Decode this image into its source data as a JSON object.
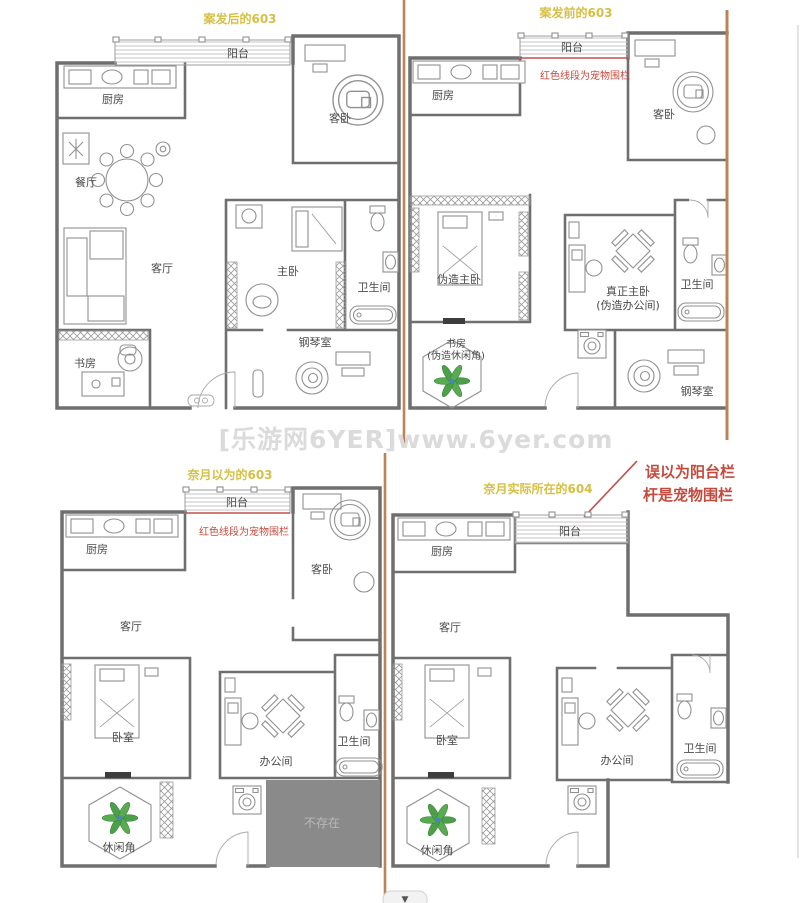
{
  "watermark": {
    "text": "[乐游网6YER]www.6yer.com"
  },
  "page": {
    "scroll_indicator": "▼"
  },
  "colors": {
    "title_yellow": "#d6bf45",
    "annotation_red": "#c44a3d",
    "pet_fence_red": "#c0504d",
    "wall_gray": "#6f6f6f",
    "furniture_gray": "#919191",
    "divider_orange": "#bd8257",
    "missing_area_fill": "#8a8a8a",
    "missing_area_text": "#b8b8b8",
    "plant_green": "#4da04a",
    "watermark_gray": "#dbdbdb"
  },
  "plans": {
    "after603": {
      "title": "案发后的603",
      "rooms": {
        "balcony": "阳台",
        "kitchen": "厨房",
        "guest": "客卧",
        "dining": "餐厅",
        "living": "客厅",
        "master": "主卧",
        "bath": "卫生间",
        "study": "书房",
        "piano": "钢琴室"
      }
    },
    "before603": {
      "title": "案发前的603",
      "fence_note": "红色线段为宠物围栏",
      "rooms": {
        "balcony": "阳台",
        "kitchen": "厨房",
        "guest": "客卧",
        "fake_master": "伪造主卧",
        "real_master_1": "真正主卧",
        "real_master_2": "(伪造办公间)",
        "bath": "卫生间",
        "study_1": "书房",
        "study_2": "(伪造休闲角)",
        "piano": "钢琴室"
      }
    },
    "imagined603": {
      "title": "奈月以为的603",
      "fence_note": "红色线段为宠物围栏",
      "rooms": {
        "balcony": "阳台",
        "kitchen": "厨房",
        "guest": "客卧",
        "living": "客厅",
        "bedroom": "卧室",
        "office": "办公间",
        "bath": "卫生间",
        "leisure": "休闲角",
        "missing": "不存在"
      }
    },
    "actual604": {
      "title": "奈月实际所在的604",
      "note_1": "误以为阳台栏",
      "note_2": "杆是宠物围栏",
      "rooms": {
        "balcony": "阳台",
        "kitchen": "厨房",
        "living": "客厅",
        "bedroom": "卧室",
        "office": "办公间",
        "bath": "卫生间",
        "leisure": "休闲角"
      }
    }
  }
}
